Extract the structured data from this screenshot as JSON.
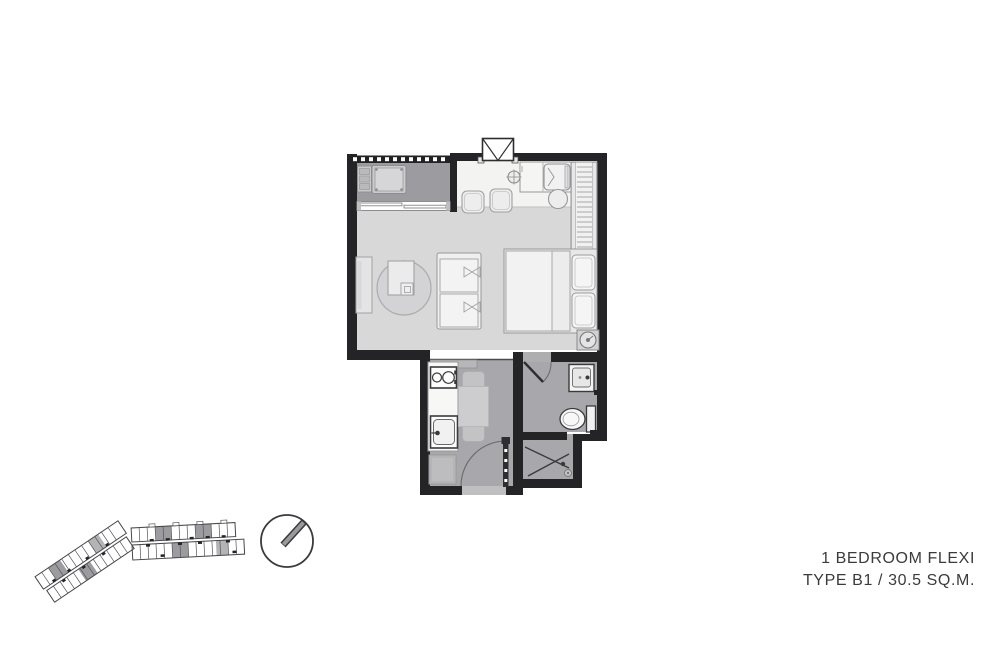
{
  "caption": {
    "line1": "1 BEDROOM FLEXI",
    "line2": "TYPE B1 / 30.5 SQ.M.",
    "unit_type": "B1",
    "unit_area": "30.5 SQ.M."
  },
  "colors": {
    "background": "#ffffff",
    "wall": "#242426",
    "floor_living": "#d8d8d9",
    "floor_balcony": "#9b9ba0",
    "floor_wet": "#a8a8ac",
    "furniture_light": "#f2f2f2",
    "fixture_outline": "#3a3a3c",
    "keyplan_highlight": "#9c9ca0",
    "caption_text": "#3b3b3b"
  },
  "floor_plan": {
    "rooms": [
      "balcony",
      "living-sleeping-area",
      "kitchenette-bar",
      "kitchen",
      "bathroom",
      "shower"
    ],
    "fixtures": [
      "ac-unit",
      "balcony-railing",
      "sliding-door",
      "breakfast-counter",
      "fridge",
      "bar-stools",
      "round-table",
      "wardrobe",
      "double-bed",
      "pillows",
      "sofa",
      "coffee-table",
      "rug",
      "tv-console",
      "fan",
      "hob",
      "kitchen-sink",
      "washing-machine",
      "dining-table",
      "entry-door",
      "bathroom-door",
      "vanity-basin",
      "toilet",
      "shower-screen",
      "floor-drain",
      "shaft"
    ]
  },
  "key_plan": {
    "description": "building key plan with highlighted unit locations"
  },
  "compass": {
    "description": "north-arrow"
  }
}
